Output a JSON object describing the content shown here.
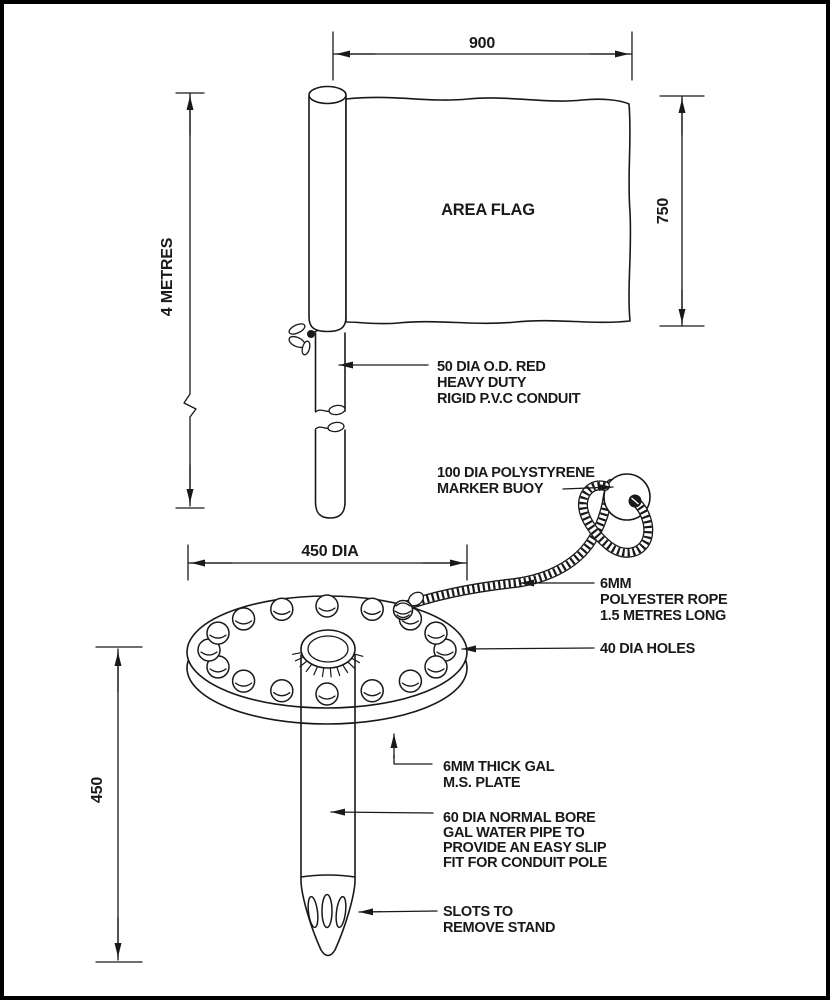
{
  "page": {
    "paper": "#ffffff",
    "ink": "#191919"
  },
  "flag": {
    "label": "AREA FLAG"
  },
  "dimensions": {
    "flag_width": "900",
    "flag_height": "750",
    "pole_height": "4 METRES",
    "plate_diameter": "450 DIA",
    "stand_height": "450"
  },
  "annotations": {
    "conduit": [
      "50 DIA O.D. RED",
      "HEAVY DUTY",
      "RIGID P.V.C CONDUIT"
    ],
    "buoy": [
      "100 DIA POLYSTYRENE",
      "MARKER BUOY"
    ],
    "rope": [
      "6MM",
      "POLYESTER ROPE",
      "1.5 METRES LONG"
    ],
    "holes": [
      "40 DIA HOLES"
    ],
    "plate": [
      "6MM THICK GAL",
      "M.S. PLATE"
    ],
    "pipe": [
      "60 DIA NORMAL BORE",
      "GAL WATER PIPE TO",
      "PROVIDE AN EASY SLIP",
      "FIT FOR CONDUIT POLE"
    ],
    "slots": [
      "SLOTS TO",
      "REMOVE STAND"
    ]
  }
}
